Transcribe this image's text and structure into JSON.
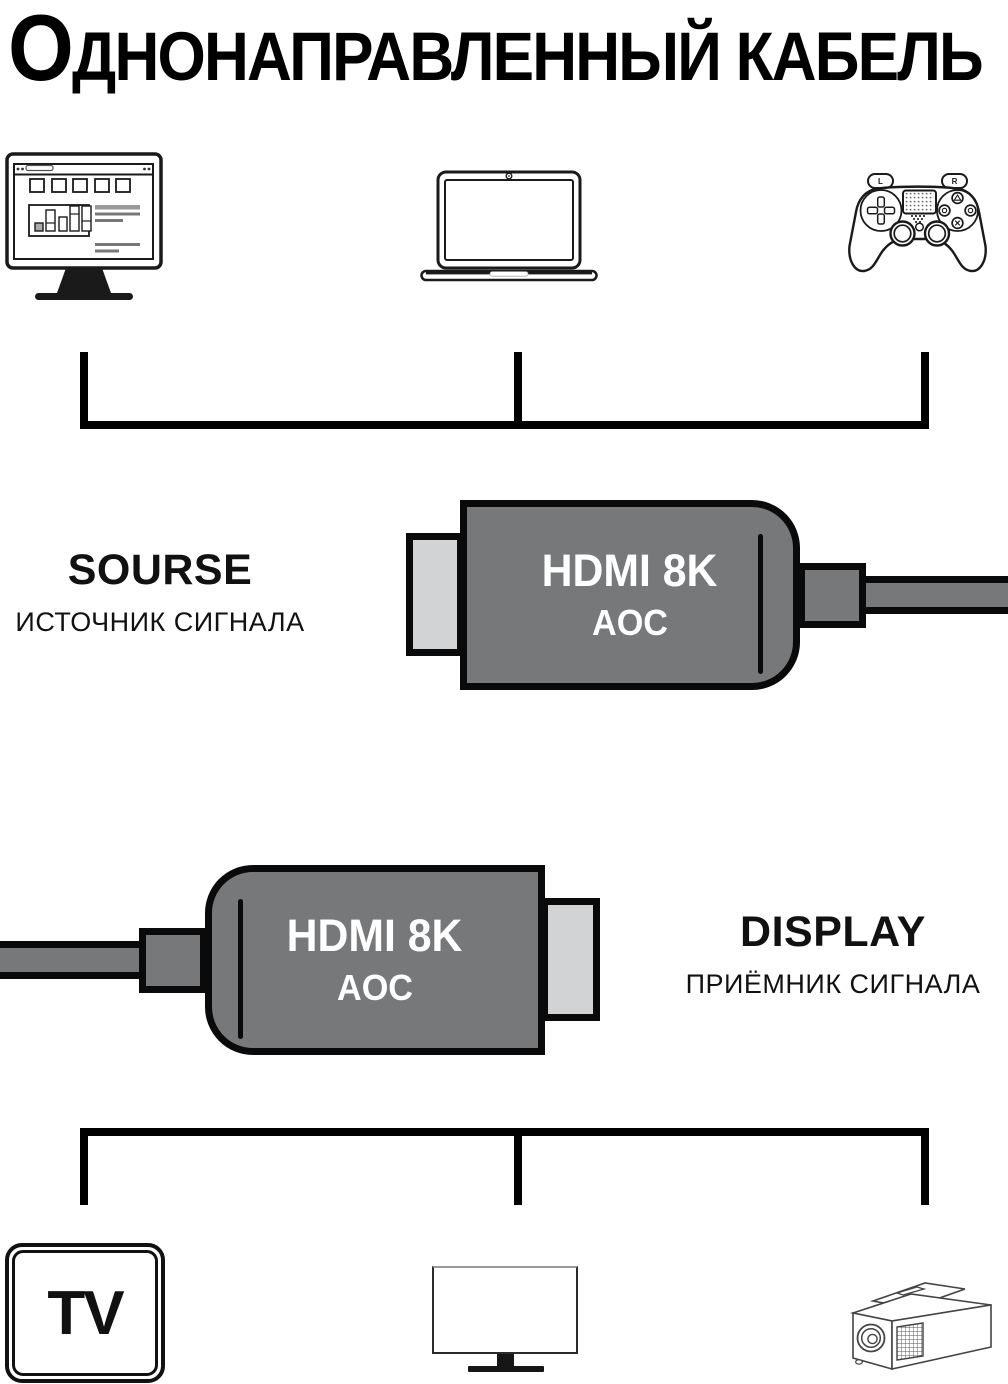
{
  "title": "Однонаправленный кабель",
  "source": {
    "label": "SOURSE",
    "sublabel": "ИСТОЧНИК СИГНАЛА"
  },
  "display": {
    "label": "DISPLAY",
    "sublabel": "ПРИЁМНИК СИГНАЛА"
  },
  "cable_top": {
    "line1": "HDMI 8K",
    "line2": "AOC"
  },
  "cable_bottom": {
    "line1": "HDMI 8K",
    "line2": "AOC"
  },
  "gamepad": {
    "left_bumper": "L",
    "right_bumper": "R"
  },
  "tv": {
    "label": "TV"
  },
  "colors": {
    "connector_body": "#77787A",
    "connector_tip": "#D2D3D5",
    "outline": "#0A0A0A",
    "connector_text": "#FFFFFF",
    "ink": "#000000",
    "background": "#FFFFFF"
  }
}
